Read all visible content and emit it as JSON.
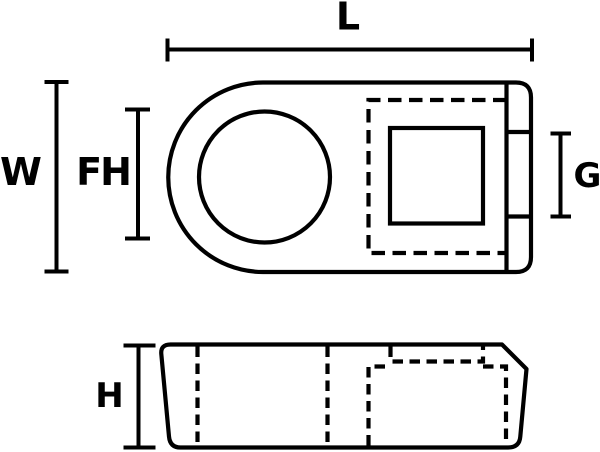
{
  "drawing": {
    "background_color": "#ffffff",
    "line_color": "#000000",
    "dimensions": {
      "L": {
        "label": "L"
      },
      "W": {
        "label": "W"
      },
      "FH": {
        "label": "FH"
      },
      "G": {
        "label": "G"
      },
      "H": {
        "label": "H"
      }
    }
  }
}
